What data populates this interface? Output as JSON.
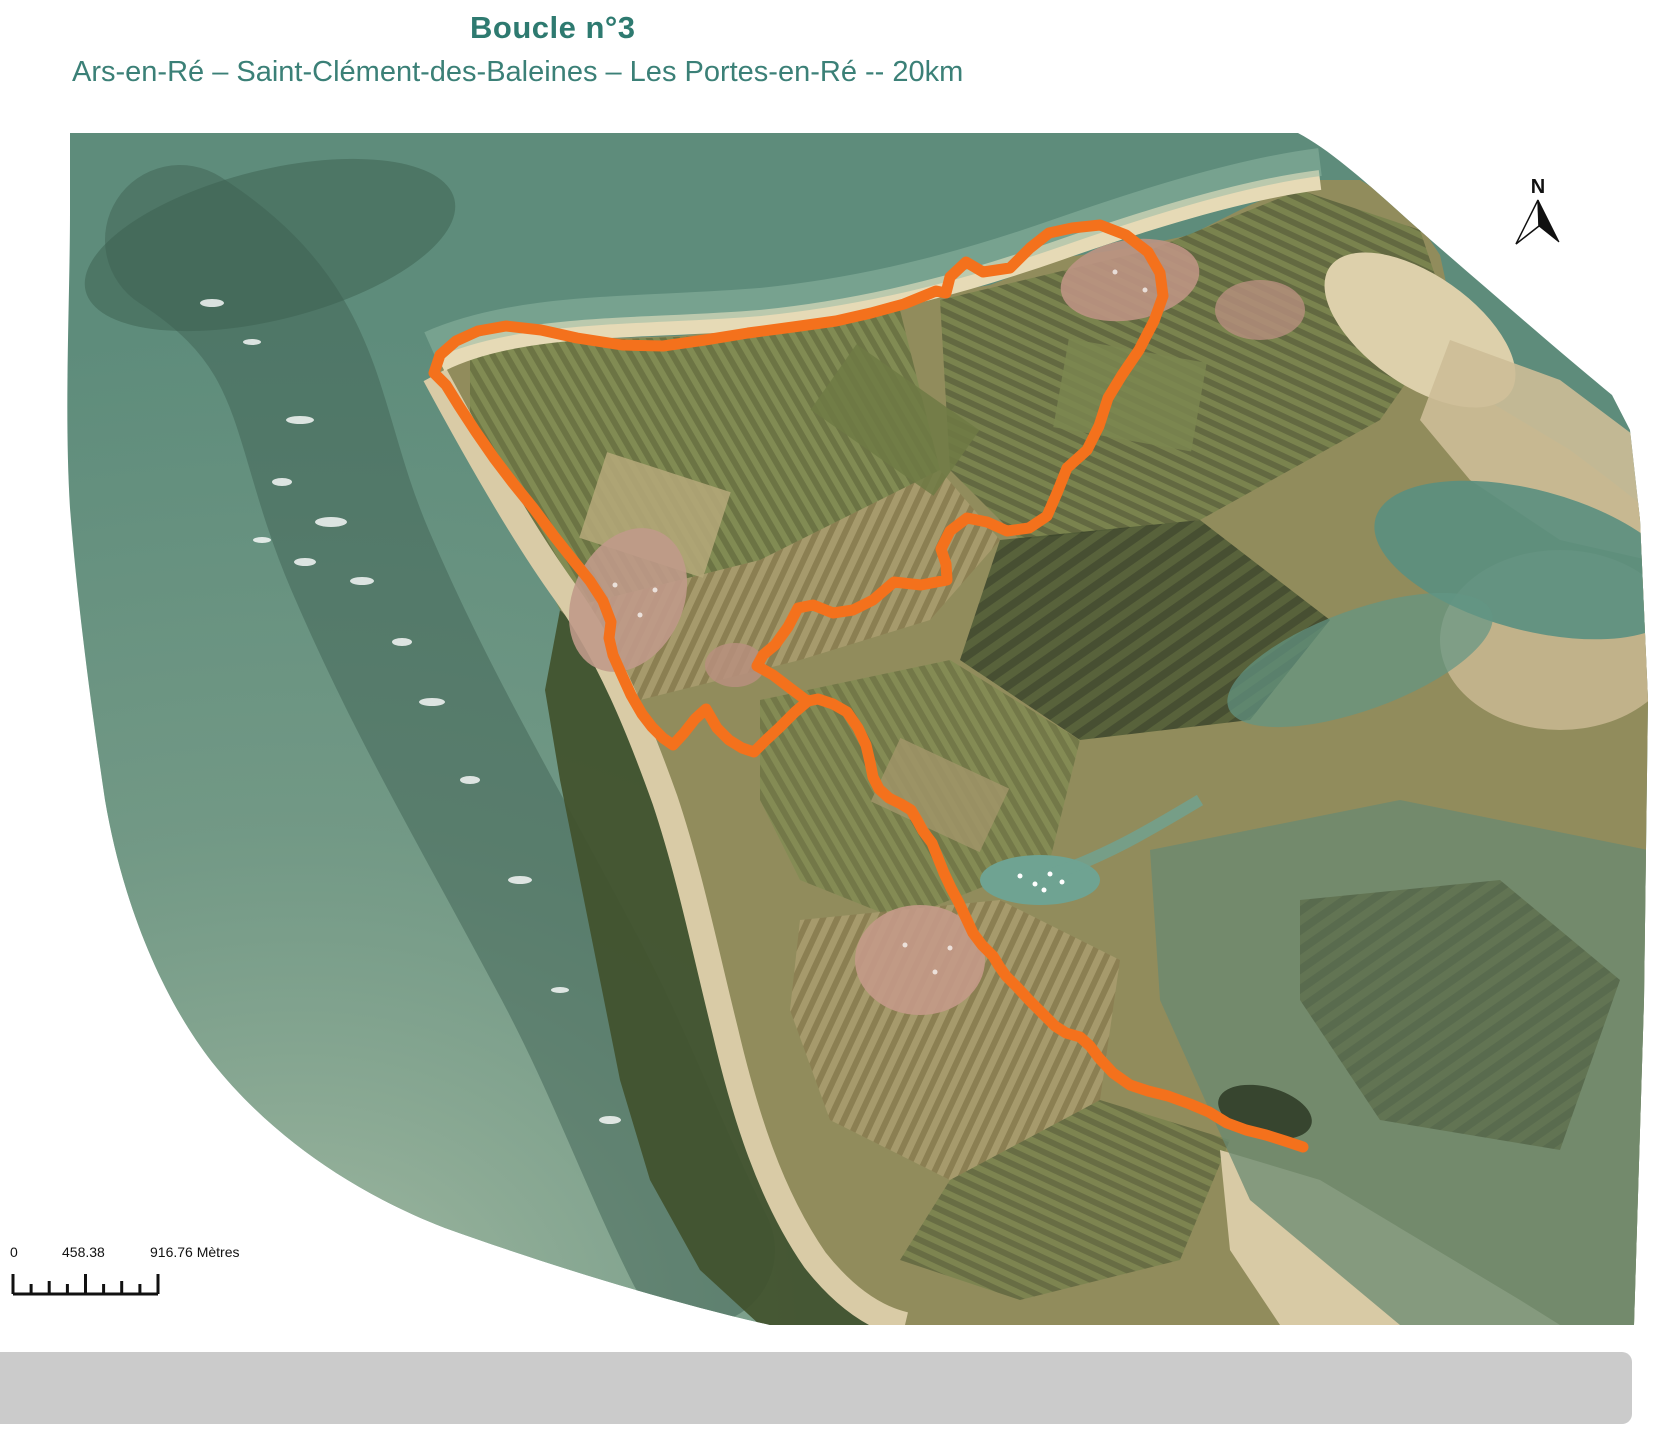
{
  "header": {
    "title": "Boucle n°3",
    "subtitle": "Ars-en-Ré – Saint-Clément-des-Baleines – Les Portes-en-Ré -- 20km"
  },
  "map": {
    "north_label": "N"
  },
  "scalebar": {
    "start": "0",
    "middle": "458.38",
    "end": "916.76 Mètres"
  },
  "route": {
    "path_d": "M 1303,1147 L 1285,1141 L 1266,1135 L 1246,1130 L 1227,1123 L 1209,1112 L 1190,1104 L 1168,1096 L 1148,1091 L 1130,1085 L 1113,1073 L 1099,1058 L 1090,1046 L 1080,1037 L 1066,1033 L 1055,1026 L 1043,1014 L 1029,1000 L 1017,987 L 1006,976 L 999,966 L 993,956 L 982,945 L 973,933 L 966,918 L 959,903 L 951,888 L 944,873 L 938,858 L 932,843 L 923,831 L 917,820 L 911,810 L 901,804 L 889,798 L 879,789 L 873,777 L 870,762 L 866,745 L 858,728 L 847,712 L 833,704 L 818,699 L 808,701 L 795,712 L 779,728 L 765,741 L 754,752 L 742,748 L 729,740 L 717,728 L 706,709 L 695,719 L 684,733 L 673,745 L 663,738 L 652,727 L 642,714 L 631,695 L 621,673 L 613,655 L 609,638 L 611,622 L 603,601 L 590,581 L 573,560 L 554,536 L 534,509 L 513,483 L 494,458 L 476,432 L 459,406 L 446,385 L 434,373 L 440,355 L 456,341 L 478,331 L 506,326 L 541,330 L 577,338 L 622,345 L 663,346 L 705,340 L 748,333 L 793,327 L 836,321 L 871,313 L 904,304 L 936,291 L 946,293 L 950,277 L 966,262 L 983,272 L 1010,268 L 1030,248 L 1049,233 L 1072,228 L 1100,225 L 1126,235 L 1148,252 L 1160,273 L 1163,296 L 1154,321 L 1139,350 L 1122,375 L 1108,398 L 1099,426 L 1087,450 L 1067,468 L 1057,493 L 1047,516 L 1029,528 L 1007,531 L 987,522 L 967,518 L 950,531 L 941,549 L 946,564 L 947,580 L 921,585 L 894,582 L 873,600 L 853,610 L 833,613 L 813,605 L 798,608 L 788,627 L 775,645 L 763,655 L 757,666 L 773,675 L 790,688 L 806,700"
  },
  "colors": {
    "title_teal": "#2E7A70",
    "subtitle_teal": "#3B8077",
    "route_orange": "#F4711C",
    "footer_gray": "#CBCBCB",
    "sea_teal": "#5E8C7B",
    "sand_tan": "#D9CBA6",
    "land_olive": "#918C5C"
  }
}
